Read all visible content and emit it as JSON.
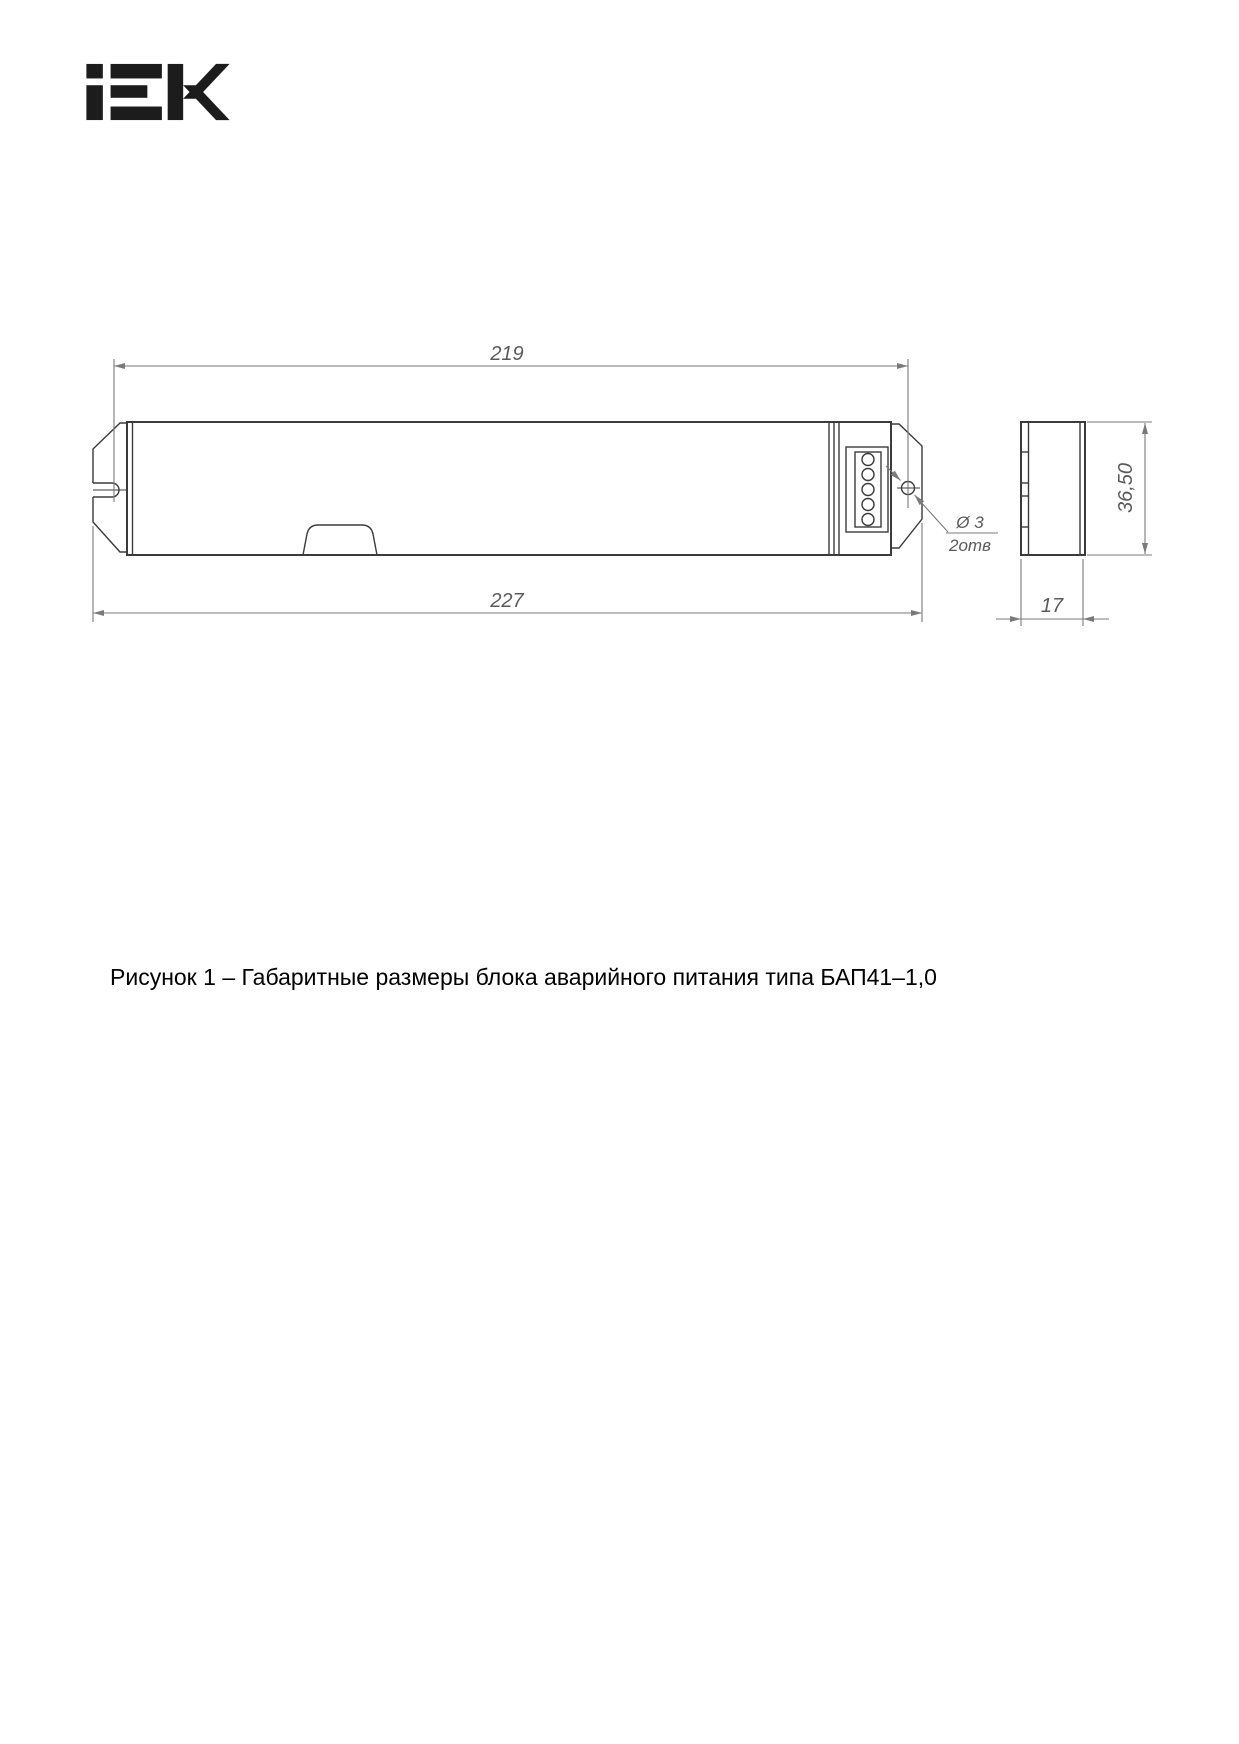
{
  "page": {
    "background": "#ffffff"
  },
  "logo": {
    "text": "IEK",
    "color": "#1c1c1c"
  },
  "figure": {
    "dimensions": {
      "mounting_distance": "219",
      "overall_length": "227",
      "height": "36,50",
      "depth": "17",
      "hole_diameter": "Ø 3",
      "hole_count": "2отв"
    },
    "colors": {
      "outline": "#3b3b3b",
      "dimension_lines": "#7a7a7a",
      "dimension_text": "#5a5a5a"
    }
  },
  "caption": {
    "text": "Рисунок 1 – Габаритные размеры блока аварийного питания типа БАП41–1,0"
  }
}
